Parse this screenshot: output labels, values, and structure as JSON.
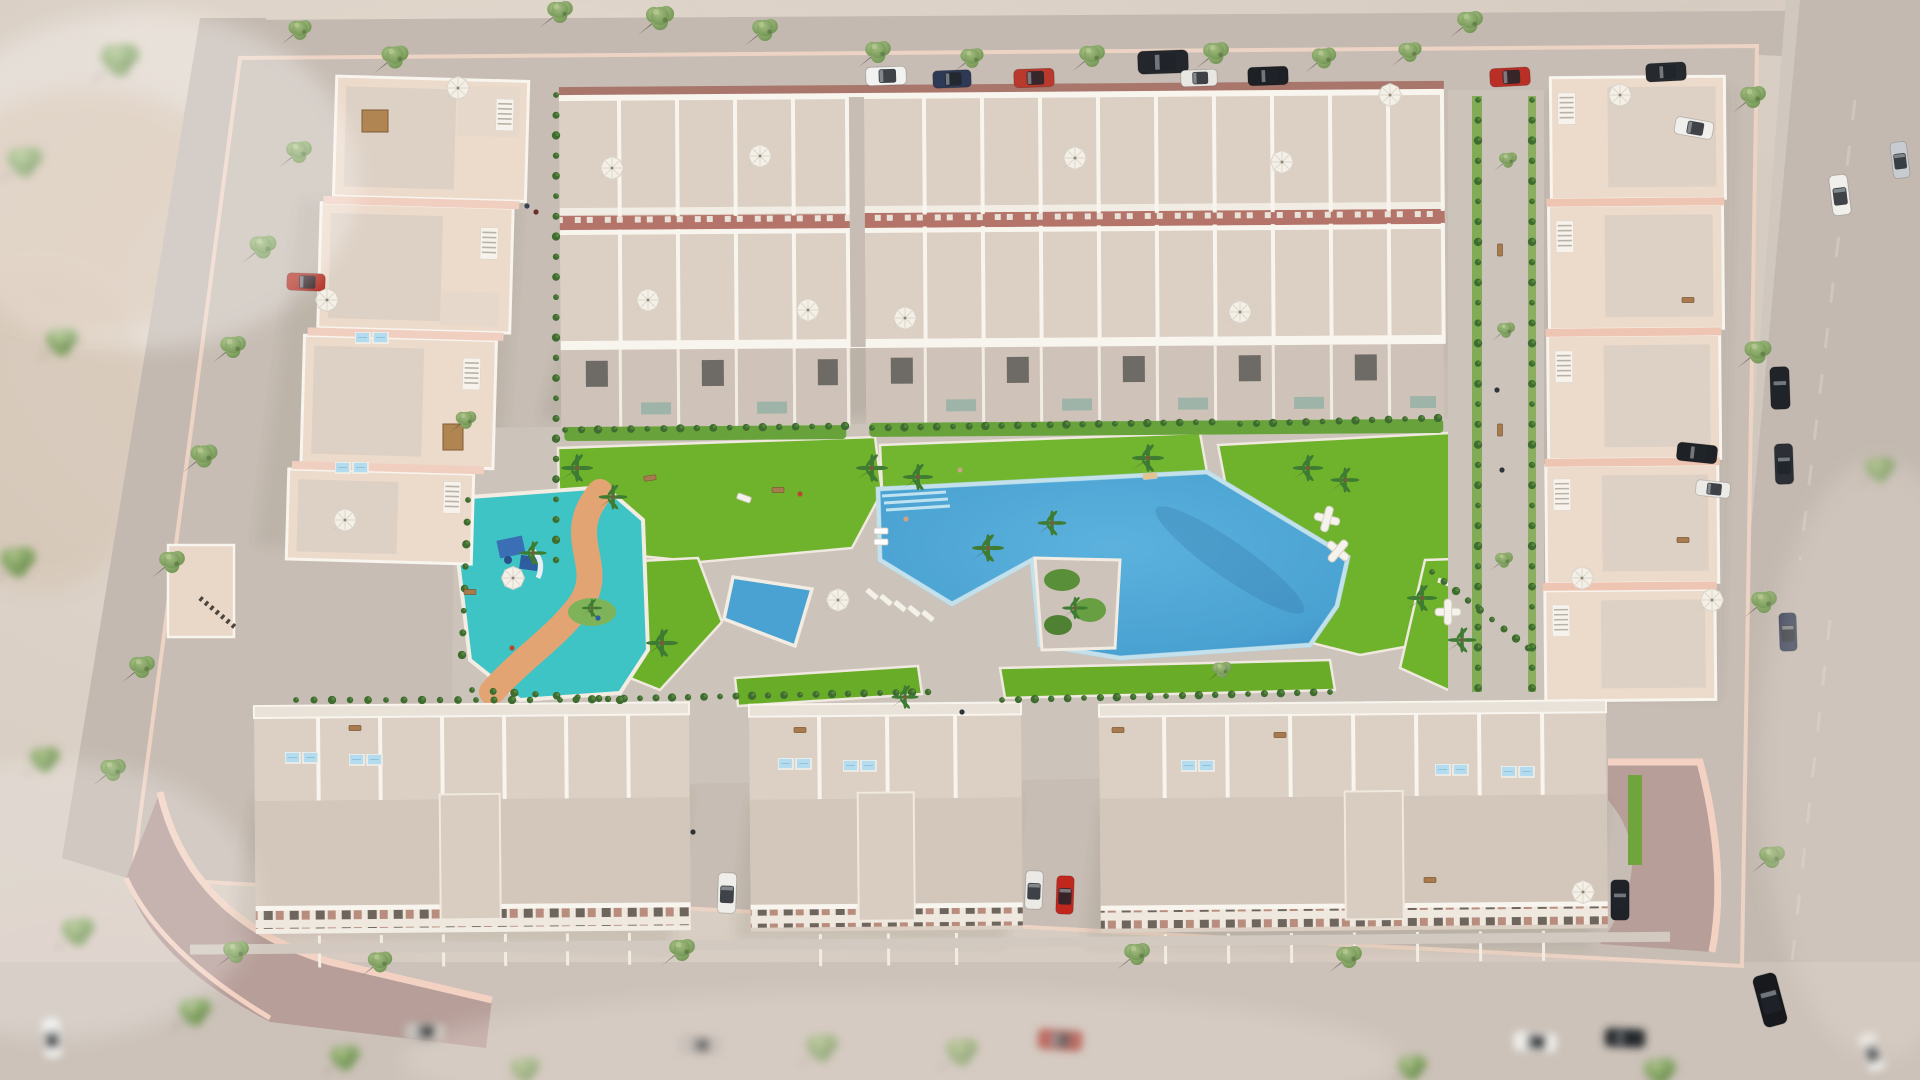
{
  "meta": {
    "title": "aerial-render-residential-complex",
    "type": "3d-architectural-visualization",
    "description": "Bird's-eye render of a beige/pink residential development with central pool park, kids splash pool, lawns, palms, perimeter roads, parked cars and trees"
  },
  "palette": {
    "sand": "#d9cfc4",
    "sandLight": "#e5dcd2",
    "sandPink": "#ddcdc6",
    "road": "#c3b9b0",
    "roadLight": "#cfc6bd",
    "pave": "#c7bdb4",
    "paveLight": "#d2c9c0",
    "paveMauve": "#b79e99",
    "wallPink": "#f0cfc0",
    "wallDeep": "#e9bba8",
    "beige": "#ecdacb",
    "terrace": "#dccfc3",
    "terraceLight": "#e6dace",
    "slab": "#d3c6ba",
    "white": "#f8f4ee",
    "redStrip": "#b4746a",
    "brick": "#a9766c",
    "lawn": "#6fb32c",
    "lawnDark": "#5a9722",
    "bush": "#3e6b2f",
    "treeGreen": "#8aa968",
    "treeDark": "#5f7f49",
    "palmGreen": "#3f7c33",
    "poolBlue": "#52abd8",
    "poolDeep": "#3e90c6",
    "poolLight": "#aadcef",
    "kidsPool": "#3ec4c4",
    "kidsPath": "#e3a473",
    "shadow": "#4e463c"
  },
  "scene": {
    "trees": [
      {
        "x": 560,
        "y": 12,
        "s": 1
      },
      {
        "x": 660,
        "y": 18,
        "s": 1.1
      },
      {
        "x": 765,
        "y": 30,
        "s": 1
      },
      {
        "x": 878,
        "y": 52,
        "s": 1
      },
      {
        "x": 972,
        "y": 58,
        "s": 0.9
      },
      {
        "x": 1092,
        "y": 56,
        "s": 1
      },
      {
        "x": 1216,
        "y": 53,
        "s": 1
      },
      {
        "x": 1324,
        "y": 58,
        "s": 0.95
      },
      {
        "x": 1410,
        "y": 52,
        "s": 0.9
      },
      {
        "x": 1470,
        "y": 22,
        "s": 1
      },
      {
        "x": 395,
        "y": 57,
        "s": 1.05
      },
      {
        "x": 300,
        "y": 30,
        "s": 0.9
      },
      {
        "x": 299,
        "y": 152,
        "s": 1
      },
      {
        "x": 263,
        "y": 247,
        "s": 1.05
      },
      {
        "x": 233,
        "y": 347,
        "s": 1
      },
      {
        "x": 204,
        "y": 456,
        "s": 1.05
      },
      {
        "x": 172,
        "y": 562,
        "s": 1
      },
      {
        "x": 142,
        "y": 667,
        "s": 1
      },
      {
        "x": 113,
        "y": 770,
        "s": 1
      },
      {
        "x": 1753,
        "y": 97,
        "s": 1
      },
      {
        "x": 1758,
        "y": 352,
        "s": 1.05
      },
      {
        "x": 1764,
        "y": 602,
        "s": 1
      },
      {
        "x": 1772,
        "y": 857,
        "s": 1
      },
      {
        "x": 236,
        "y": 952,
        "s": 1
      },
      {
        "x": 380,
        "y": 962,
        "s": 0.95
      },
      {
        "x": 682,
        "y": 950,
        "s": 1
      },
      {
        "x": 1137,
        "y": 954,
        "s": 1
      },
      {
        "x": 1349,
        "y": 957,
        "s": 1
      },
      {
        "x": 1508,
        "y": 160,
        "s": 0.7
      },
      {
        "x": 1506,
        "y": 330,
        "s": 0.7
      },
      {
        "x": 1504,
        "y": 560,
        "s": 0.7
      },
      {
        "x": 466,
        "y": 420,
        "s": 0.8
      },
      {
        "x": 1222,
        "y": 670,
        "s": 0.75
      }
    ],
    "blurTrees": [
      {
        "x": 25,
        "y": 162,
        "s": 1.2
      },
      {
        "x": 62,
        "y": 342,
        "s": 1.1
      },
      {
        "x": 18,
        "y": 562,
        "s": 1.2
      },
      {
        "x": 78,
        "y": 932,
        "s": 1.1
      },
      {
        "x": 195,
        "y": 1012,
        "s": 1.1
      },
      {
        "x": 345,
        "y": 1058,
        "s": 1
      },
      {
        "x": 525,
        "y": 1070,
        "s": 1
      },
      {
        "x": 822,
        "y": 1048,
        "s": 1.1
      },
      {
        "x": 962,
        "y": 1052,
        "s": 1.1
      },
      {
        "x": 1412,
        "y": 1068,
        "s": 1
      },
      {
        "x": 1660,
        "y": 1072,
        "s": 1.1
      },
      {
        "x": 120,
        "y": 60,
        "s": 1.3
      },
      {
        "x": 45,
        "y": 760,
        "s": 1
      },
      {
        "x": 1880,
        "y": 470,
        "s": 1
      }
    ],
    "palms": [
      {
        "x": 577,
        "y": 468,
        "s": 1
      },
      {
        "x": 613,
        "y": 497,
        "s": 0.9
      },
      {
        "x": 872,
        "y": 468,
        "s": 1
      },
      {
        "x": 918,
        "y": 477,
        "s": 0.95
      },
      {
        "x": 1148,
        "y": 458,
        "s": 1
      },
      {
        "x": 1308,
        "y": 468,
        "s": 0.95
      },
      {
        "x": 988,
        "y": 548,
        "s": 1
      },
      {
        "x": 1052,
        "y": 523,
        "s": 0.9
      },
      {
        "x": 662,
        "y": 643,
        "s": 1
      },
      {
        "x": 533,
        "y": 553,
        "s": 0.85
      },
      {
        "x": 1422,
        "y": 598,
        "s": 0.95
      },
      {
        "x": 1462,
        "y": 640,
        "s": 0.9
      },
      {
        "x": 1345,
        "y": 480,
        "s": 0.9
      },
      {
        "x": 592,
        "y": 608,
        "s": 0.65
      },
      {
        "x": 905,
        "y": 697,
        "s": 0.85
      },
      {
        "x": 1075,
        "y": 608,
        "s": 0.8
      }
    ],
    "cars": [
      {
        "x": 886,
        "y": 76,
        "r": -2,
        "c": "#f2f2f0",
        "s": 1
      },
      {
        "x": 952,
        "y": 79,
        "r": -2,
        "c": "#2e3a55",
        "s": 0.95
      },
      {
        "x": 1034,
        "y": 78,
        "r": -2,
        "c": "#b93a2c",
        "s": 1
      },
      {
        "x": 1163,
        "y": 62,
        "r": -2,
        "c": "#23262b",
        "s": 1.25
      },
      {
        "x": 1199,
        "y": 78,
        "r": -2,
        "c": "#e9e7e2",
        "s": 0.9
      },
      {
        "x": 1268,
        "y": 76,
        "r": -2,
        "c": "#1d2024",
        "s": 1
      },
      {
        "x": 1510,
        "y": 77,
        "r": -3,
        "c": "#b92f26",
        "s": 1
      },
      {
        "x": 1666,
        "y": 72,
        "r": -3,
        "c": "#26292e",
        "s": 1
      },
      {
        "x": 1840,
        "y": 195,
        "r": 83,
        "c": "#f0efec",
        "s": 1
      },
      {
        "x": 1900,
        "y": 160,
        "r": 83,
        "c": "#c8ccd0",
        "s": 0.9
      },
      {
        "x": 1780,
        "y": 388,
        "r": 88,
        "c": "#202328",
        "s": 1.05
      },
      {
        "x": 1784,
        "y": 464,
        "r": 88,
        "c": "#2c2f35",
        "s": 1
      },
      {
        "x": 1788,
        "y": 632,
        "r": 88,
        "c": "#2a3550",
        "s": 0.95
      },
      {
        "x": 1770,
        "y": 1000,
        "r": 75,
        "c": "#17191d",
        "s": 1.3
      },
      {
        "x": 306,
        "y": 282,
        "r": 2,
        "c": "#b33125",
        "s": 0.95
      },
      {
        "x": 1694,
        "y": 128,
        "r": 10,
        "c": "#f1efec",
        "s": 0.95
      },
      {
        "x": 1697,
        "y": 453,
        "r": 6,
        "c": "#1e2125",
        "s": 1
      },
      {
        "x": 1713,
        "y": 489,
        "r": 6,
        "c": "#eceae6",
        "s": 0.85
      },
      {
        "x": 727,
        "y": 893,
        "r": 92,
        "c": "#f0eeea",
        "s": 1
      },
      {
        "x": 1034,
        "y": 890,
        "r": 92,
        "c": "#eceae6",
        "s": 0.95
      },
      {
        "x": 1065,
        "y": 895,
        "r": 92,
        "c": "#c1271d",
        "s": 0.95
      },
      {
        "x": 1620,
        "y": 900,
        "r": 90,
        "c": "#1f2328",
        "s": 1
      }
    ],
    "blurCars": [
      {
        "x": 52,
        "y": 1038,
        "r": 85,
        "c": "#f0efec",
        "s": 1
      },
      {
        "x": 425,
        "y": 1032,
        "r": 2,
        "c": "#c7c2bc",
        "s": 1
      },
      {
        "x": 1060,
        "y": 1040,
        "r": 4,
        "c": "#a83227",
        "s": 1.1
      },
      {
        "x": 1535,
        "y": 1042,
        "r": 4,
        "c": "#efede9",
        "s": 1.1
      },
      {
        "x": 1625,
        "y": 1038,
        "r": 2,
        "c": "#2a2d31",
        "s": 1
      },
      {
        "x": 700,
        "y": 1045,
        "r": 3,
        "c": "#b9b4ae",
        "s": 1
      },
      {
        "x": 1872,
        "y": 1052,
        "r": 70,
        "c": "#eceae6",
        "s": 1
      }
    ],
    "umbrellas": [
      {
        "x": 327,
        "y": 300
      },
      {
        "x": 345,
        "y": 520
      },
      {
        "x": 612,
        "y": 168
      },
      {
        "x": 760,
        "y": 156
      },
      {
        "x": 648,
        "y": 300
      },
      {
        "x": 808,
        "y": 310
      },
      {
        "x": 1075,
        "y": 158
      },
      {
        "x": 1282,
        "y": 162
      },
      {
        "x": 905,
        "y": 318
      },
      {
        "x": 1240,
        "y": 312
      },
      {
        "x": 1390,
        "y": 95
      },
      {
        "x": 1620,
        "y": 95
      },
      {
        "x": 1582,
        "y": 578
      },
      {
        "x": 1712,
        "y": 600
      },
      {
        "x": 513,
        "y": 578
      },
      {
        "x": 838,
        "y": 600
      },
      {
        "x": 1583,
        "y": 892
      },
      {
        "x": 458,
        "y": 88
      }
    ],
    "skylights": [
      {
        "x": 302,
        "y": 758
      },
      {
        "x": 366,
        "y": 760
      },
      {
        "x": 795,
        "y": 764
      },
      {
        "x": 860,
        "y": 766
      },
      {
        "x": 1198,
        "y": 766
      },
      {
        "x": 1452,
        "y": 770
      },
      {
        "x": 1518,
        "y": 772
      },
      {
        "x": 372,
        "y": 338
      },
      {
        "x": 352,
        "y": 468
      }
    ],
    "loungers": [
      {
        "x": 872,
        "y": 594,
        "r": 40,
        "c": "#f4f1ea"
      },
      {
        "x": 886,
        "y": 600,
        "r": 40,
        "c": "#f4f1ea"
      },
      {
        "x": 900,
        "y": 606,
        "r": 40,
        "c": "#f4f1ea"
      },
      {
        "x": 914,
        "y": 611,
        "r": 40,
        "c": "#f4f1ea"
      },
      {
        "x": 928,
        "y": 616,
        "r": 40,
        "c": "#f4f1ea"
      },
      {
        "x": 881,
        "y": 531,
        "r": 0,
        "c": "#ffffff"
      },
      {
        "x": 881,
        "y": 542,
        "r": 0,
        "c": "#ffffff"
      },
      {
        "x": 1150,
        "y": 476,
        "r": -5,
        "c": "#e2c391"
      },
      {
        "x": 744,
        "y": 498,
        "r": 20,
        "c": "#f4f1ea"
      }
    ],
    "sculptures": [
      {
        "x": 1327,
        "y": 519,
        "r": 15
      },
      {
        "x": 1338,
        "y": 551,
        "r": 40
      },
      {
        "x": 1448,
        "y": 612,
        "r": 0
      }
    ],
    "benches": [
      {
        "x": 778,
        "y": 490,
        "r": 0
      },
      {
        "x": 650,
        "y": 478,
        "r": -8
      },
      {
        "x": 1500,
        "y": 250,
        "r": 90
      },
      {
        "x": 1500,
        "y": 430,
        "r": 90
      },
      {
        "x": 355,
        "y": 728,
        "r": 0
      },
      {
        "x": 800,
        "y": 730,
        "r": 0
      },
      {
        "x": 1280,
        "y": 735,
        "r": 0
      },
      {
        "x": 1430,
        "y": 880,
        "r": 0
      },
      {
        "x": 470,
        "y": 592,
        "r": 0
      },
      {
        "x": 1688,
        "y": 300,
        "r": 0
      },
      {
        "x": 1683,
        "y": 540,
        "r": 0
      },
      {
        "x": 1118,
        "y": 730,
        "r": 0
      }
    ],
    "pergolas": [
      {
        "x": 362,
        "y": 110,
        "w": 26,
        "h": 22
      },
      {
        "x": 443,
        "y": 424,
        "w": 20,
        "h": 26
      }
    ],
    "people": [
      {
        "x": 800,
        "y": 494,
        "c": "#b5492f"
      },
      {
        "x": 906,
        "y": 519,
        "c": "#caa286"
      },
      {
        "x": 960,
        "y": 470,
        "c": "#caa286"
      },
      {
        "x": 527,
        "y": 206,
        "c": "#3a4254"
      },
      {
        "x": 536,
        "y": 212,
        "c": "#6b2f2a"
      },
      {
        "x": 1497,
        "y": 390,
        "c": "#30343b"
      },
      {
        "x": 1502,
        "y": 470,
        "c": "#30343b"
      },
      {
        "x": 693,
        "y": 832,
        "c": "#2f3338"
      },
      {
        "x": 962,
        "y": 712,
        "c": "#2f3338"
      },
      {
        "x": 598,
        "y": 618,
        "c": "#2f5ea0"
      },
      {
        "x": 512,
        "y": 648,
        "c": "#b5492f"
      }
    ],
    "bushStrips": [
      {
        "x1": 565,
        "y1": 430,
        "x2": 845,
        "y2": 426,
        "n": 18
      },
      {
        "x1": 872,
        "y1": 428,
        "x2": 1212,
        "y2": 422,
        "n": 22
      },
      {
        "x1": 1240,
        "y1": 424,
        "x2": 1438,
        "y2": 418,
        "n": 13
      },
      {
        "x1": 560,
        "y1": 700,
        "x2": 928,
        "y2": 692,
        "n": 24
      },
      {
        "x1": 1002,
        "y1": 700,
        "x2": 1330,
        "y2": 692,
        "n": 21
      },
      {
        "x1": 1478,
        "y1": 100,
        "x2": 1478,
        "y2": 688,
        "n": 30
      },
      {
        "x1": 1532,
        "y1": 100,
        "x2": 1532,
        "y2": 688,
        "n": 30
      },
      {
        "x1": 556,
        "y1": 95,
        "x2": 556,
        "y2": 560,
        "n": 24
      },
      {
        "x1": 468,
        "y1": 500,
        "x2": 462,
        "y2": 655,
        "n": 8
      },
      {
        "x1": 472,
        "y1": 690,
        "x2": 620,
        "y2": 700,
        "n": 8
      },
      {
        "x1": 1432,
        "y1": 572,
        "x2": 1528,
        "y2": 648,
        "n": 9
      },
      {
        "x1": 296,
        "y1": 700,
        "x2": 530,
        "y2": 700,
        "n": 14
      }
    ]
  }
}
